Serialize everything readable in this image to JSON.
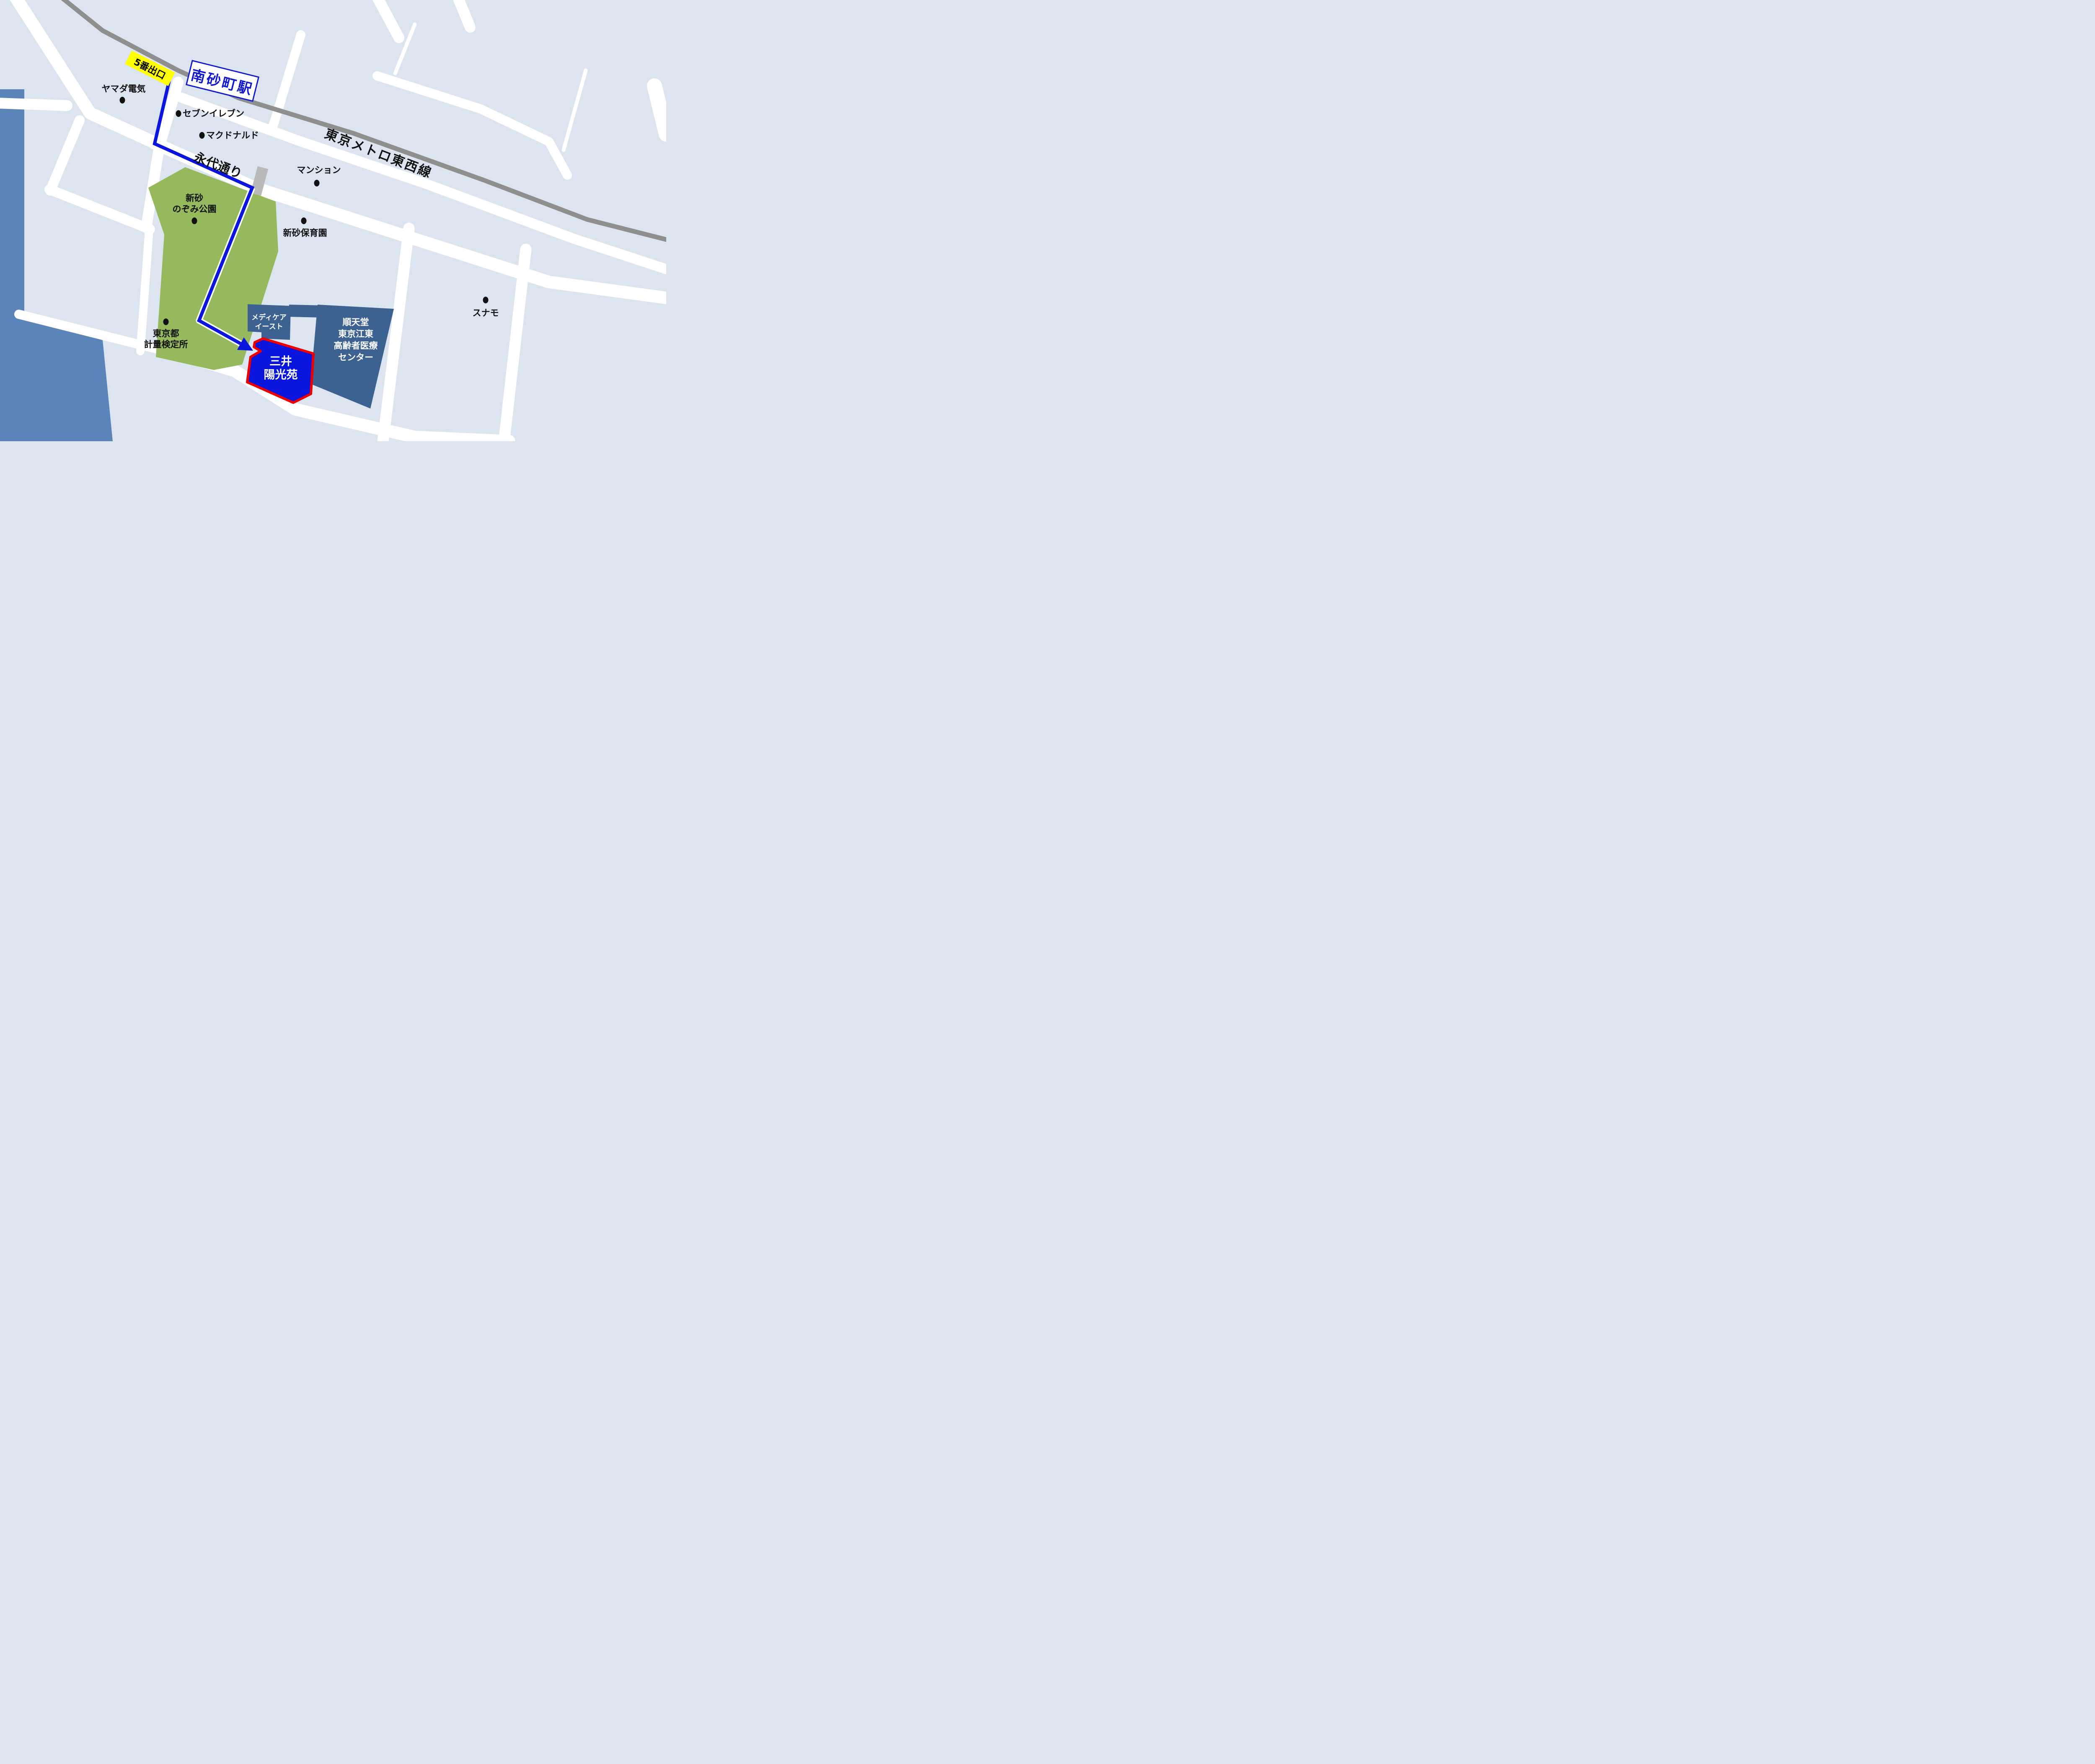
{
  "colors": {
    "background": "#dce4f0",
    "road": "#ffffff",
    "railway_gray": "#8f8f8f",
    "water_blue": "#5b84b8",
    "park_green": "#95b95c",
    "building_slate": "#3c6292",
    "route_blue": "#0a16dd",
    "destination_fill": "#0a16dd",
    "destination_border": "#ee0000",
    "exit_label_bg": "#ffff00",
    "station_sign_blue": "#1218cf"
  },
  "station": {
    "sign": "南砂町駅",
    "exit": "5番出口"
  },
  "lines": {
    "railway": "東京メトロ東西線",
    "road": "永代通り"
  },
  "pois": {
    "yamada": {
      "label": "ヤマダ電気"
    },
    "seven_eleven": {
      "label": "セブンイレブン"
    },
    "mcdonalds": {
      "label": "マクドナルド"
    },
    "mansion": {
      "label": "マンション"
    },
    "nozomi_park": {
      "label": "新砂\nのぞみ公園"
    },
    "hoikuen": {
      "label": "新砂保育園"
    },
    "keiryo": {
      "label": "東京都\n計量検定所"
    },
    "sunamo": {
      "label": "スナモ"
    }
  },
  "buildings": {
    "medicare": {
      "label": "メディケア\nイースト"
    },
    "juntendo": {
      "label": "順天堂\n東京江東\n高齢者医療\nセンター"
    },
    "destination": {
      "label": "三井\n陽光苑"
    }
  }
}
